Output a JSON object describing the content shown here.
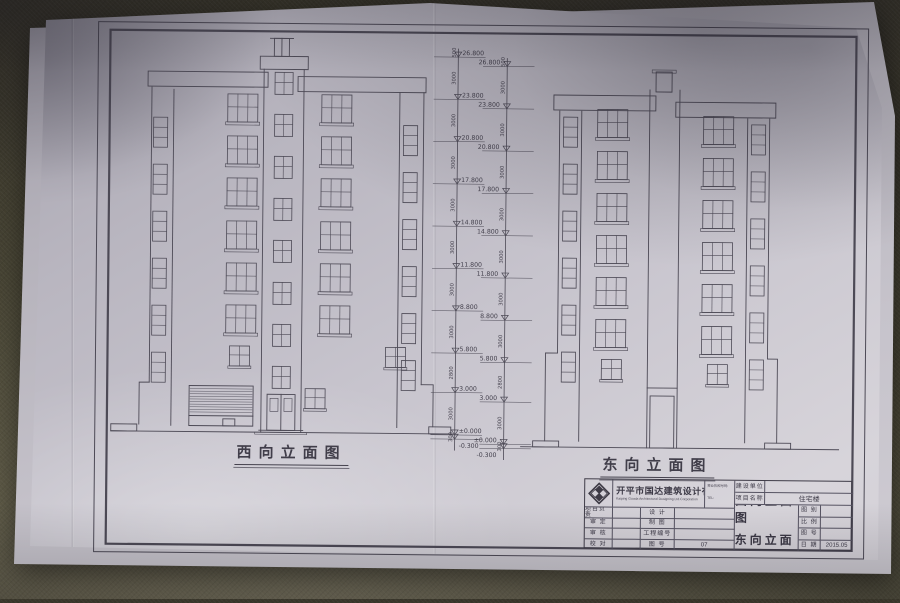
{
  "drawing": {
    "caption_west": "西向立面图",
    "caption_east": "东向立面图",
    "levels": [
      "26.800",
      "23.800",
      "20.800",
      "17.800",
      "14.800",
      "11.800",
      "8.800",
      "5.800",
      "3.000",
      "±0.000",
      "-0.300"
    ],
    "intervals": [
      "500",
      "3000",
      "3000",
      "3000",
      "3000",
      "3000",
      "3000",
      "3000",
      "2800",
      "3000",
      "300"
    ]
  },
  "title_block": {
    "company_cn": "开平市国达建筑设计有限公司",
    "company_en": "Kaiping Guoda Architectural Designing Ltd.Corporation",
    "license_label": "营业执照号码:",
    "tel_label": "TEL:",
    "client_label": "建设单位",
    "project_label": "项目名称",
    "project_value": "住宅楼",
    "approve_labels": [
      "项目负责",
      "审 定",
      "审 核",
      "校 对"
    ],
    "design_labels": [
      "设 计",
      "制 图",
      "工程编号",
      "图 号"
    ],
    "drawing_no_value": "07",
    "sheet_title_line1": "西向立面图",
    "sheet_title_line2": "东向立面图",
    "meta_labels": [
      "图 别",
      "比 例",
      "图 号",
      "日 期"
    ],
    "meta_values": [
      "",
      "",
      "",
      "2015.05"
    ]
  }
}
